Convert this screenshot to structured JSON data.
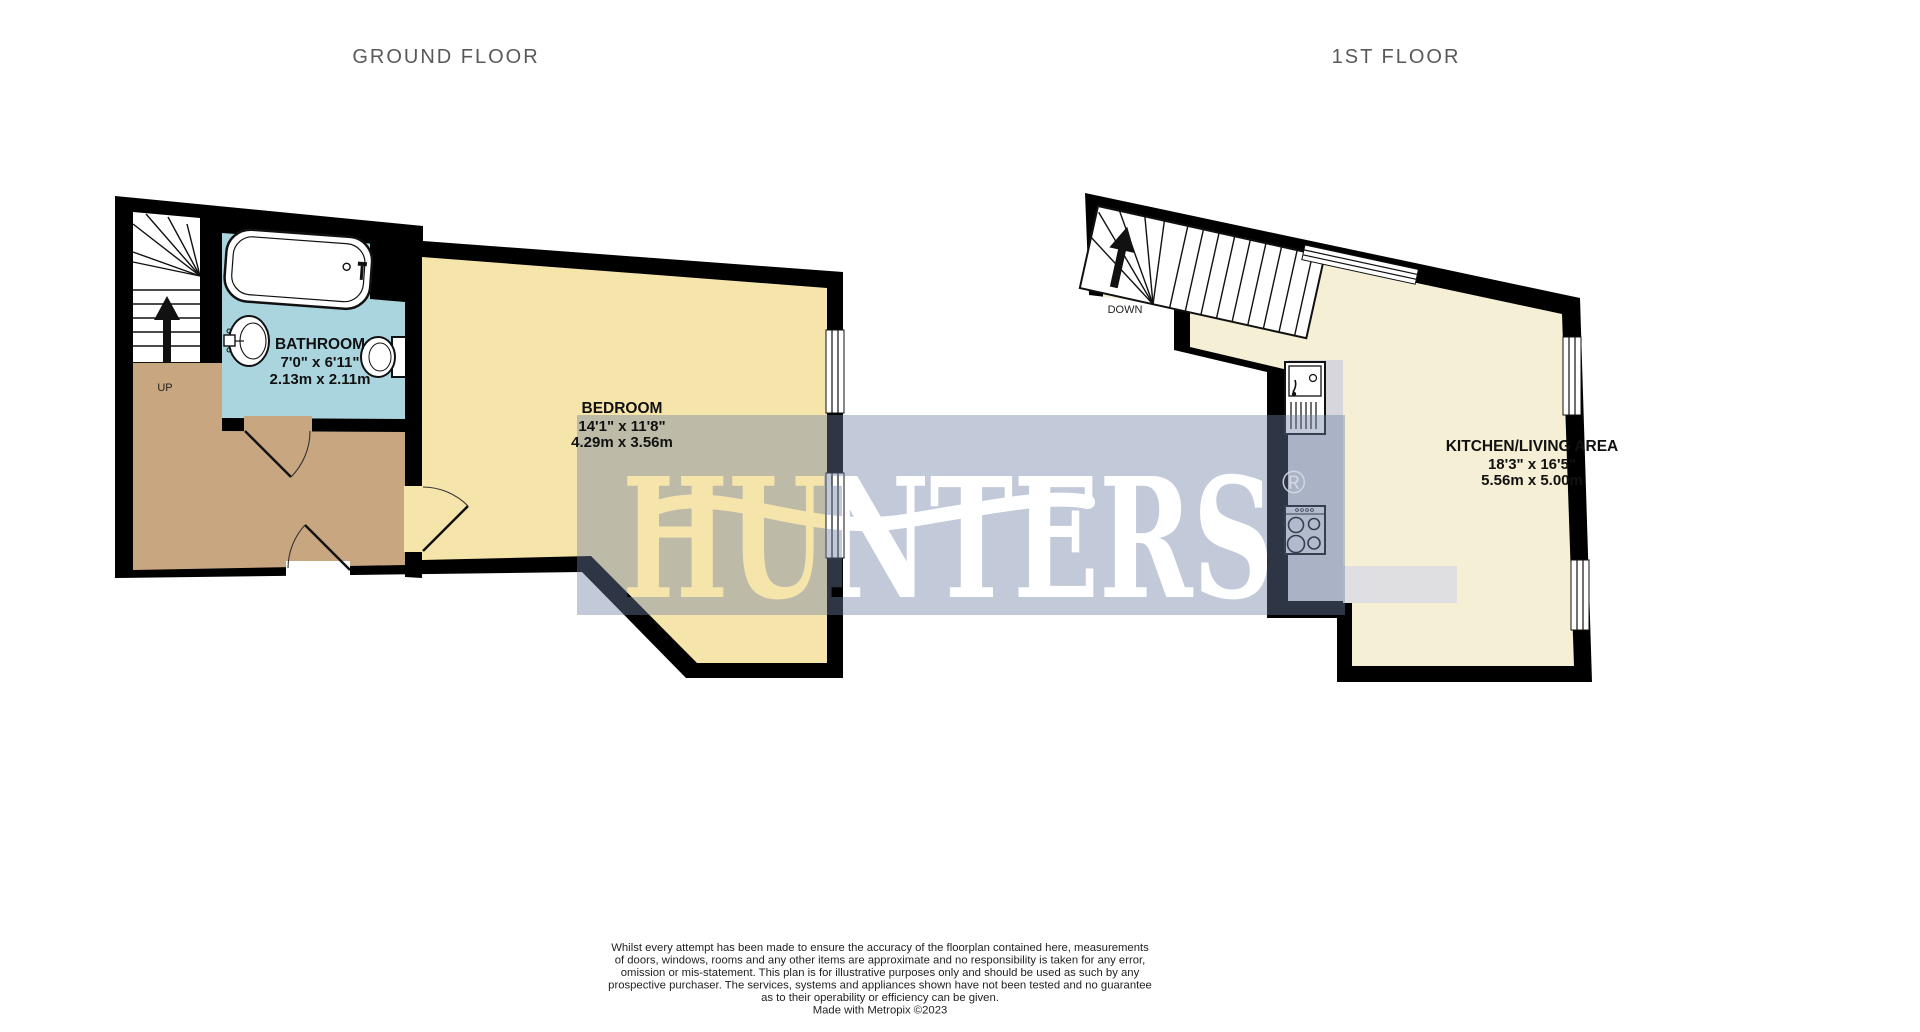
{
  "titles": {
    "ground_floor": "GROUND FLOOR",
    "first_floor": "1ST FLOOR"
  },
  "ground_floor": {
    "stairs_label": "UP",
    "rooms": [
      {
        "name": "BATHROOM",
        "imperial": "7'0\"  x 6'11\"",
        "metric": "2.13m  x 2.11m"
      },
      {
        "name": "BEDROOM",
        "imperial": "14'1\"  x 11'8\"",
        "metric": "4.29m  x 3.56m"
      }
    ]
  },
  "first_floor": {
    "stairs_label": "DOWN",
    "rooms": [
      {
        "name": "KITCHEN/LIVING AREA",
        "imperial": "18'3\"  x 16'5\"",
        "metric": "5.56m  x 5.00m"
      }
    ]
  },
  "watermark": {
    "text": "HUNTERS",
    "registered_mark": "®"
  },
  "disclaimer": {
    "lines": [
      "Whilst every attempt has been made to ensure the accuracy of the floorplan contained here, measurements",
      "of doors, windows, rooms and any other items are approximate and no responsibility is taken for any error,",
      "omission or mis-statement. This plan is for illustrative purposes only and should be used as such by any",
      "prospective purchaser. The services, systems and appliances shown have not been tested and no guarantee",
      "as to their operability or efficiency can be given.",
      "Made with Metropix ©2023"
    ]
  },
  "colors": {
    "wall": "#000000",
    "stairs": "#FFFFFF",
    "bathroom": "#ABD5DE",
    "hallway": "#C8A680",
    "bedroom": "#F6E5AB",
    "living": "#F5EFD5",
    "counter": "#D6D6DC",
    "counter_light": "#DFDFE1",
    "hob": "#E4E4EA",
    "watermark_band": "rgba(110,129,165,0.42)",
    "registered_mark_color": "#D5DAE5"
  }
}
